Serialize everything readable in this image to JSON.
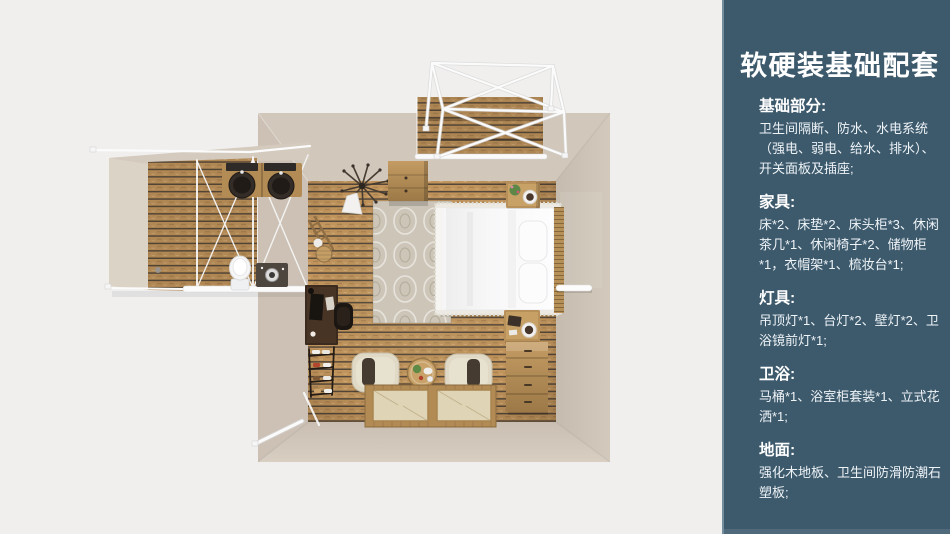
{
  "sidebar": {
    "title": "软硬装基础配套",
    "background_color": "#3d5a6d",
    "text_color": "#ffffff",
    "sections": [
      {
        "heading": "基础部分:",
        "body": "卫生间隔断、防水、水电系统（强电、弱电、给水、排水）、开关面板及插座;"
      },
      {
        "heading": "家具:",
        "body": "床*2、床垫*2、床头柜*3、休闲茶几*1、休闲椅子*2、储物柜*1，衣帽架*1、梳妆台*1;"
      },
      {
        "heading": "灯具:",
        "body": "吊顶灯*1、台灯*2、壁灯*2、卫浴镜前灯*1;"
      },
      {
        "heading": "卫浴:",
        "body": "马桶*1、浴室柜套装*1、立式花洒*1;"
      },
      {
        "heading": "地面:",
        "body": "强化木地板、卫生间防滑防潮石塑板;"
      }
    ]
  },
  "floorplan": {
    "view": "top-down-room-render",
    "colors": {
      "background": "#f0efee",
      "wall": "#d1c7ba",
      "floor_plank": "#c2955c",
      "frame_white": "#fbfbfb",
      "bedding": "#f8f8f9"
    },
    "objects": [
      "balcony-canopy-frame",
      "balcony-wood-deck",
      "storage-cabinet",
      "ceiling-lamp",
      "area-rug",
      "double-bed",
      "pillows",
      "headboard",
      "nightstand-top",
      "nightstand-bottom",
      "dresser",
      "desk",
      "desk-chair",
      "clothes-rack",
      "shoe-rack",
      "armchair-left",
      "armchair-right",
      "coffee-table",
      "floor-mattresses",
      "bathroom-wing",
      "double-sink-vanity",
      "toilet",
      "bathroom-cabinet",
      "door-rails"
    ]
  }
}
